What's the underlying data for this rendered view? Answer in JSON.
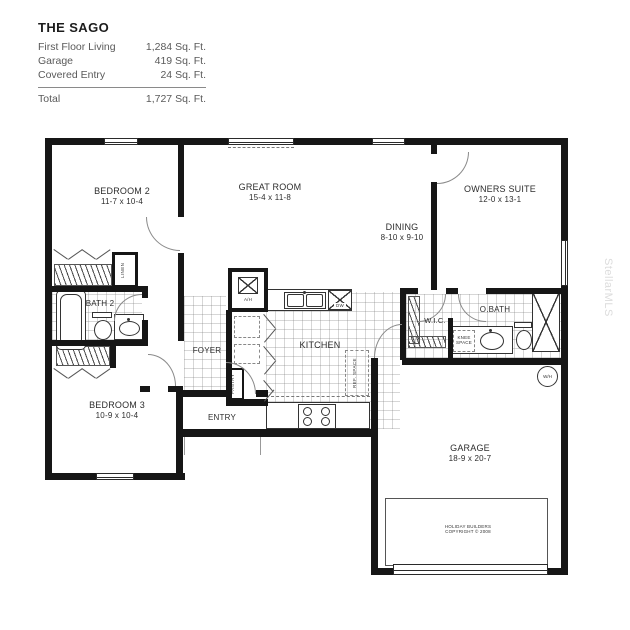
{
  "title_block": {
    "plan_name": "THE SAGO",
    "rows": [
      {
        "label": "First Floor Living",
        "value": "1,284 Sq. Ft."
      },
      {
        "label": "Garage",
        "value": "419 Sq. Ft."
      },
      {
        "label": "Covered Entry",
        "value": "24 Sq. Ft."
      }
    ],
    "total_label": "Total",
    "total_value": "1,727 Sq. Ft."
  },
  "rooms": {
    "bedroom2": {
      "name": "BEDROOM 2",
      "dims": "11-7 x 10-4"
    },
    "great_room": {
      "name": "GREAT ROOM",
      "dims": "15-4 x 11-8"
    },
    "dining": {
      "name": "DINING",
      "dims": "8-10 x 9-10"
    },
    "owners_suite": {
      "name": "OWNERS SUITE",
      "dims": "12-0 x 13-1"
    },
    "bath2": {
      "name": "BATH 2"
    },
    "wic": {
      "name": "W.I.C."
    },
    "obath": {
      "name": "O.BATH"
    },
    "foyer": {
      "name": "FOYER"
    },
    "kitchen": {
      "name": "KITCHEN"
    },
    "bedroom3": {
      "name": "BEDROOM 3",
      "dims": "10-9 x 10-4"
    },
    "entry": {
      "name": "ENTRY"
    },
    "garage": {
      "name": "GARAGE",
      "dims": "18-9 x 20-7"
    }
  },
  "labels": {
    "linen": "LINEN",
    "pantry": "PANTRY",
    "ref_space": "REF. SPACE",
    "knee_space": "KNEE SPACE",
    "air_handler": "A/H",
    "dishwasher": "DW",
    "water_heater": "W/H",
    "copyright_line1": "HOLIDAY BUILDERS",
    "copyright_line2": "COPYRIGHT © 2008",
    "watermark": "StellarMLS"
  },
  "colors": {
    "wall": "#161616",
    "label_text": "#2d2d2d",
    "fixture_line": "#333333",
    "watermark": "#dcdcdc"
  }
}
